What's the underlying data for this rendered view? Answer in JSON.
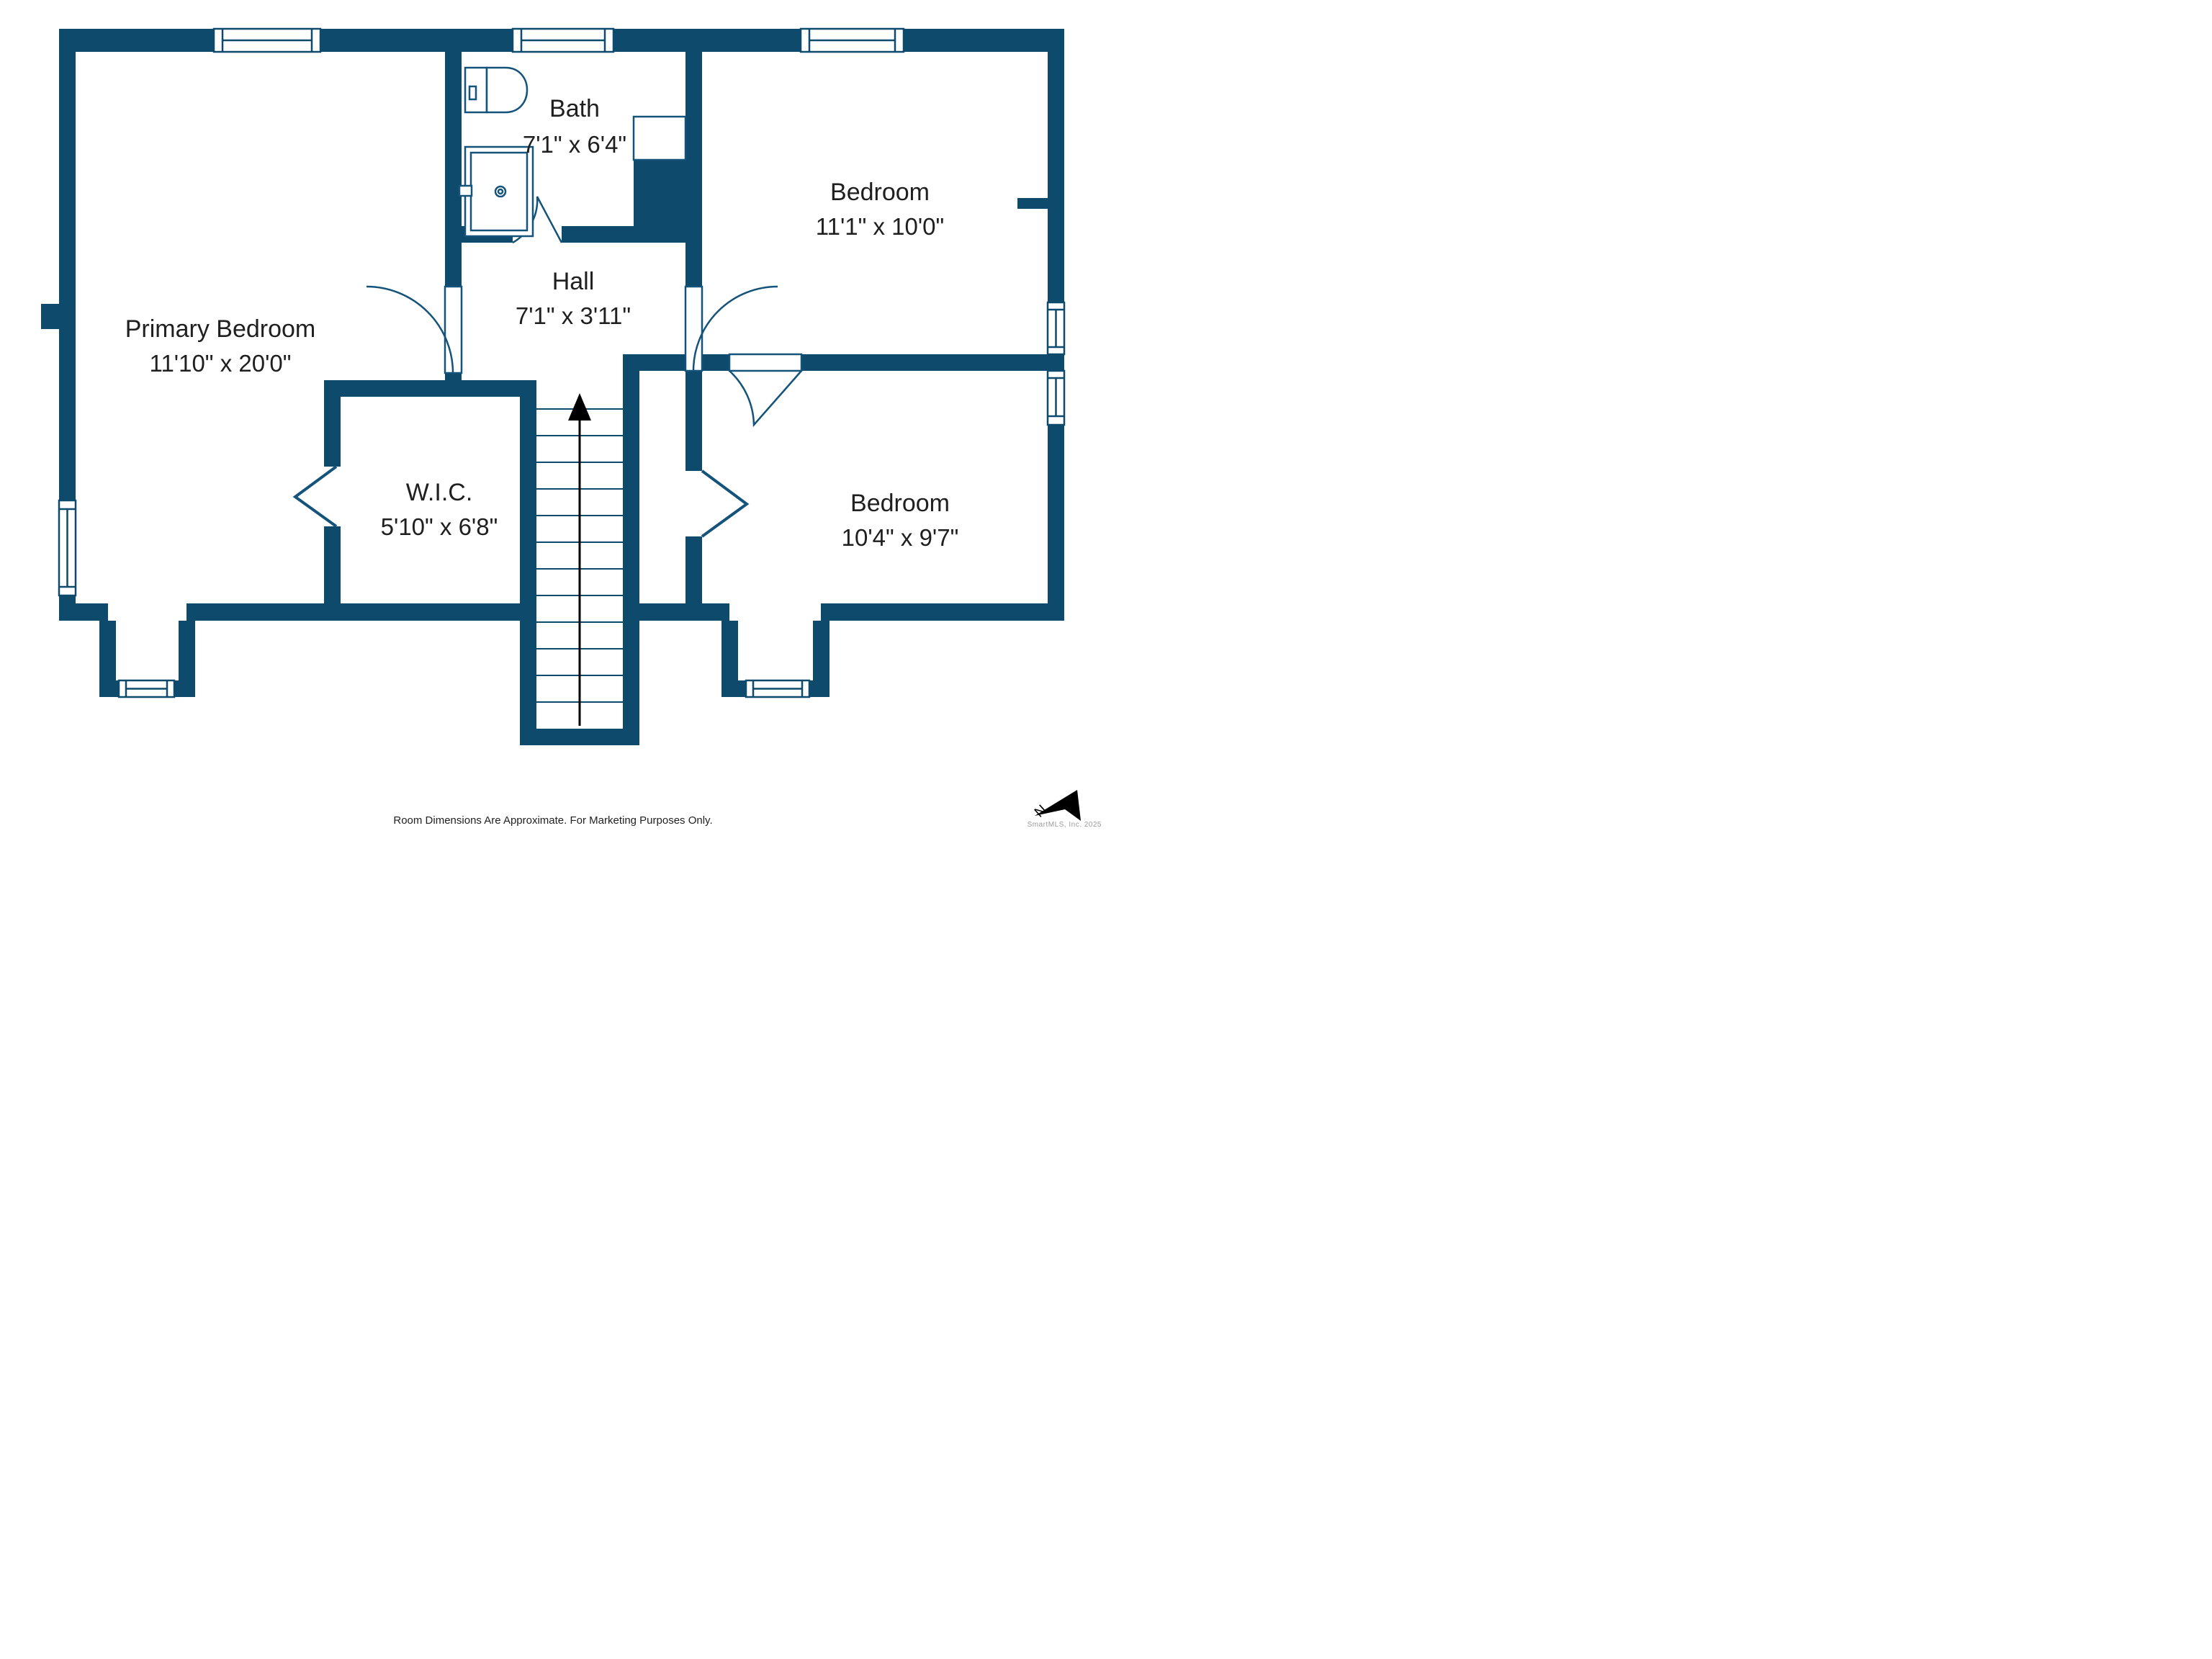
{
  "plan": {
    "rooms": [
      {
        "id": "primary-bedroom",
        "name": "Primary Bedroom",
        "dimensions": "11'10\" x 20'0\""
      },
      {
        "id": "bath",
        "name": "Bath",
        "dimensions": "7'1\" x 6'4\""
      },
      {
        "id": "hall",
        "name": "Hall",
        "dimensions": "7'1\" x 3'11\""
      },
      {
        "id": "bedroom-upper-right",
        "name": "Bedroom",
        "dimensions": "11'1\" x 10'0\""
      },
      {
        "id": "wic",
        "name": "W.I.C.",
        "dimensions": "5'10\" x 6'8\""
      },
      {
        "id": "bedroom-lower-right",
        "name": "Bedroom",
        "dimensions": "10'4\" x 9'7\""
      }
    ],
    "stairs": {
      "direction": "up"
    },
    "compass": {
      "label": "N"
    },
    "footer": {
      "disclaimer": "Room Dimensions Are Approximate. For Marketing Purposes Only."
    },
    "watermark": "SmartMLS, Inc.  2025",
    "colors": {
      "wall": "#0e4a6b",
      "fixture_line": "#14537a",
      "label_text": "#1f1f1f",
      "watermark_text": "#9a9a9a",
      "arrow": "#000000"
    }
  }
}
